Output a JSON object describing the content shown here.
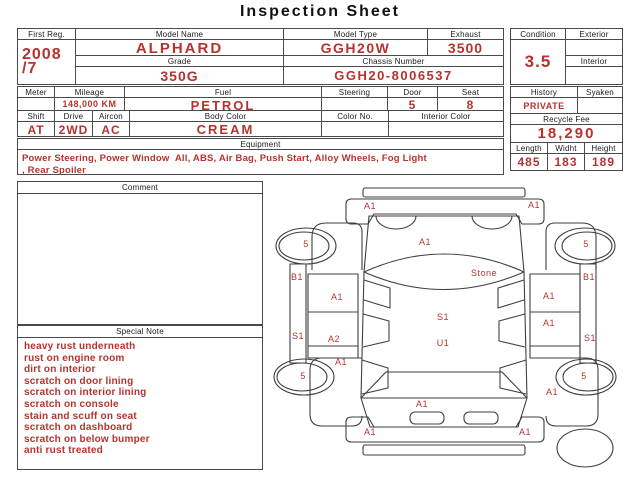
{
  "title": "Inspection Sheet",
  "colors": {
    "accent": "#b5332e",
    "line": "#4a4a4a"
  },
  "vehicle": {
    "first_reg": {
      "label": "First Reg.",
      "value": "2008\n/7"
    },
    "model_name": {
      "label": "Model Name",
      "value": "ALPHARD"
    },
    "grade": {
      "label": "Grade",
      "value": "350G"
    },
    "model_type": {
      "label": "Model Type",
      "value": "GGH20W"
    },
    "exhaust": {
      "label": "Exhaust",
      "value": "3500"
    },
    "chassis_number": {
      "label": "Chassis Number",
      "value": "GGH20-8006537"
    },
    "condition": {
      "label": "Condition",
      "value": "3.5"
    },
    "exterior": {
      "label": "Exterior",
      "value": ""
    },
    "interior": {
      "label": "Interior",
      "value": ""
    }
  },
  "specs": {
    "meter": {
      "label": "Meter",
      "value": ""
    },
    "mileage": {
      "label": "Mileage",
      "value": "148,000 KM"
    },
    "fuel": {
      "label": "Fuel",
      "value": "PETROL"
    },
    "steering": {
      "label": "Steering",
      "value": ""
    },
    "door": {
      "label": "Door",
      "value": "5"
    },
    "seat": {
      "label": "Seat",
      "value": "8"
    },
    "shift": {
      "label": "Shift",
      "value": "AT"
    },
    "drive": {
      "label": "Drive",
      "value": "2WD"
    },
    "aircon": {
      "label": "Aircon",
      "value": "AC"
    },
    "body_color": {
      "label": "Body Color",
      "value": "CREAM"
    },
    "color_no": {
      "label": "Color No.",
      "value": ""
    },
    "interior_color": {
      "label": "Interior Color",
      "value": ""
    }
  },
  "history_block": {
    "history": {
      "label": "History",
      "value": "PRIVATE"
    },
    "syaken": {
      "label": "Syaken",
      "value": ""
    },
    "recycle_fee": {
      "label": "Recycle Fee",
      "value": "18,290"
    },
    "length": {
      "label": "Length",
      "value": "485"
    },
    "width": {
      "label": "Widht",
      "value": "183"
    },
    "height": {
      "label": "Height",
      "value": "189"
    }
  },
  "equipment": {
    "label": "Equipment",
    "value": "Power Steering, Power Window  All, ABS, Air Bag, Push Start, Alloy Wheels, Fog Light\n, Rear Spoiler"
  },
  "comment": {
    "label": "Comment",
    "value": ""
  },
  "special_note": {
    "label": "Special Note",
    "lines": [
      "heavy rust underneath",
      "rust on engine room",
      "dirt on interior",
      "scratch on door lining",
      "scratch on interior lining",
      "scratch on console",
      "stain and scuff on seat",
      "scratch on dashboard",
      "scratch on below bumper",
      "anti rust treated"
    ]
  },
  "diagram": {
    "markers": [
      {
        "label": "A1",
        "x": 102,
        "y": 26
      },
      {
        "label": "A1",
        "x": 266,
        "y": 25
      },
      {
        "label": "A1",
        "x": 157,
        "y": 62
      },
      {
        "label": "Stone",
        "x": 216,
        "y": 93
      },
      {
        "label": "S1",
        "x": 175,
        "y": 137
      },
      {
        "label": "U1",
        "x": 175,
        "y": 163
      },
      {
        "label": "A1",
        "x": 154,
        "y": 224
      },
      {
        "label": "A1",
        "x": 102,
        "y": 252
      },
      {
        "label": "A1",
        "x": 257,
        "y": 252
      },
      {
        "label": "5",
        "x": 38,
        "y": 64
      },
      {
        "label": "5",
        "x": 318,
        "y": 64
      },
      {
        "label": "5",
        "x": 35,
        "y": 196
      },
      {
        "label": "5",
        "x": 316,
        "y": 196
      },
      {
        "label": "B1",
        "x": 29,
        "y": 97
      },
      {
        "label": "S1",
        "x": 30,
        "y": 156
      },
      {
        "label": "A1",
        "x": 69,
        "y": 117
      },
      {
        "label": "A2",
        "x": 66,
        "y": 159
      },
      {
        "label": "A1",
        "x": 73,
        "y": 182
      },
      {
        "label": "B1",
        "x": 321,
        "y": 97
      },
      {
        "label": "S1",
        "x": 322,
        "y": 158
      },
      {
        "label": "A1",
        "x": 281,
        "y": 116
      },
      {
        "label": "A1",
        "x": 281,
        "y": 143
      },
      {
        "label": "A1",
        "x": 284,
        "y": 212
      }
    ]
  }
}
